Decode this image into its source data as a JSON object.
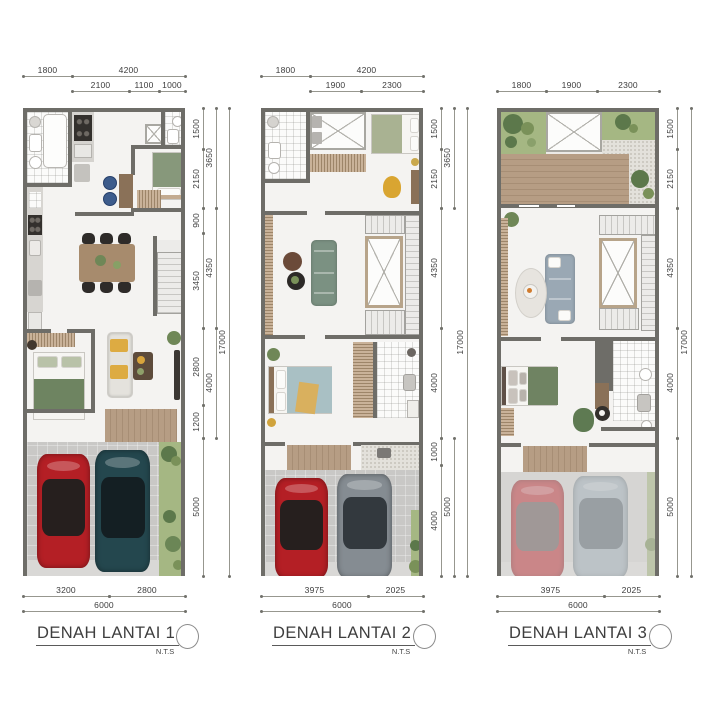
{
  "sheet": {
    "type": "architectural-floor-plans",
    "background": "#ffffff"
  },
  "palette": {
    "wall": "#6e6d68",
    "floor": "#f4f3f1",
    "garage_floor": "#c9c8c6",
    "deck_wood": "#b1987f",
    "grass": "#a5b783",
    "shrub": "#5c784b",
    "red_car": "#b41f25",
    "teal_car": "#24474e",
    "gray_car": "#858c92",
    "sage_green": "#87987b",
    "sofa_green": "#7b9182",
    "sofa_gray": "#9aa8b4",
    "accent_yellow": "#d9a531",
    "dim_text": "#3c3c3c",
    "title_text": "#3e3e3e"
  },
  "plans": [
    {
      "title": "DENAH LANTAI 1",
      "scale_note": "N.T.S",
      "dims": {
        "top_row1": [
          "1800",
          "4200"
        ],
        "top_row2": [
          "2100",
          "1100",
          "1000"
        ],
        "right_col1": [
          "1500",
          "2150",
          "900",
          "3450",
          "2800",
          "1200",
          "5000"
        ],
        "right_col2": [
          "3650",
          "4350",
          "4000"
        ],
        "right_total": "17000",
        "bottom_row1": [
          "3200",
          "2800"
        ],
        "bottom_total": "6000"
      },
      "features": [
        "bathroom",
        "kitchen",
        "pantry-void",
        "dining-table",
        "maid-bedroom",
        "stairs",
        "bedroom",
        "lounge-sofa",
        "porch-deck",
        "garage",
        "red-sports-car",
        "dark-teal-car",
        "garden-strip"
      ]
    },
    {
      "title": "DENAH LANTAI 2",
      "scale_note": "N.T.S",
      "dims": {
        "top_row1": [
          "1800",
          "4200"
        ],
        "top_row2": [
          "1900",
          "2300"
        ],
        "right_col1": [
          "1500",
          "2150",
          "4350",
          "4000",
          "1000",
          "4000"
        ],
        "right_col2": [
          "3650",
          "5000"
        ],
        "right_total": "17000",
        "bottom_row1": [
          "3975",
          "2025"
        ],
        "bottom_total": "6000"
      },
      "features": [
        "bathroom",
        "laundry-void",
        "bedroom",
        "wardrobe",
        "living-sofa",
        "stair-void",
        "stairs",
        "master-bedroom",
        "master-bathroom",
        "balcony-deck",
        "garage",
        "red-car",
        "gray-car"
      ]
    },
    {
      "title": "DENAH LANTAI 3",
      "scale_note": "N.T.S",
      "dims": {
        "top_row1": [
          "1800",
          "1900",
          "2300"
        ],
        "right_col1": [
          "1500",
          "2150",
          "4350",
          "4000",
          "5000"
        ],
        "right_col2": [],
        "right_total": "17000",
        "bottom_row1": [
          "3975",
          "2025"
        ],
        "bottom_total": "6000"
      },
      "features": [
        "roof-garden",
        "skylight",
        "gravel-path",
        "roof-deck",
        "family-room",
        "sofa",
        "rug",
        "stair-void",
        "stairs",
        "bedroom",
        "bathroom",
        "balcony-deck",
        "carport-seen-through-roof"
      ]
    }
  ]
}
